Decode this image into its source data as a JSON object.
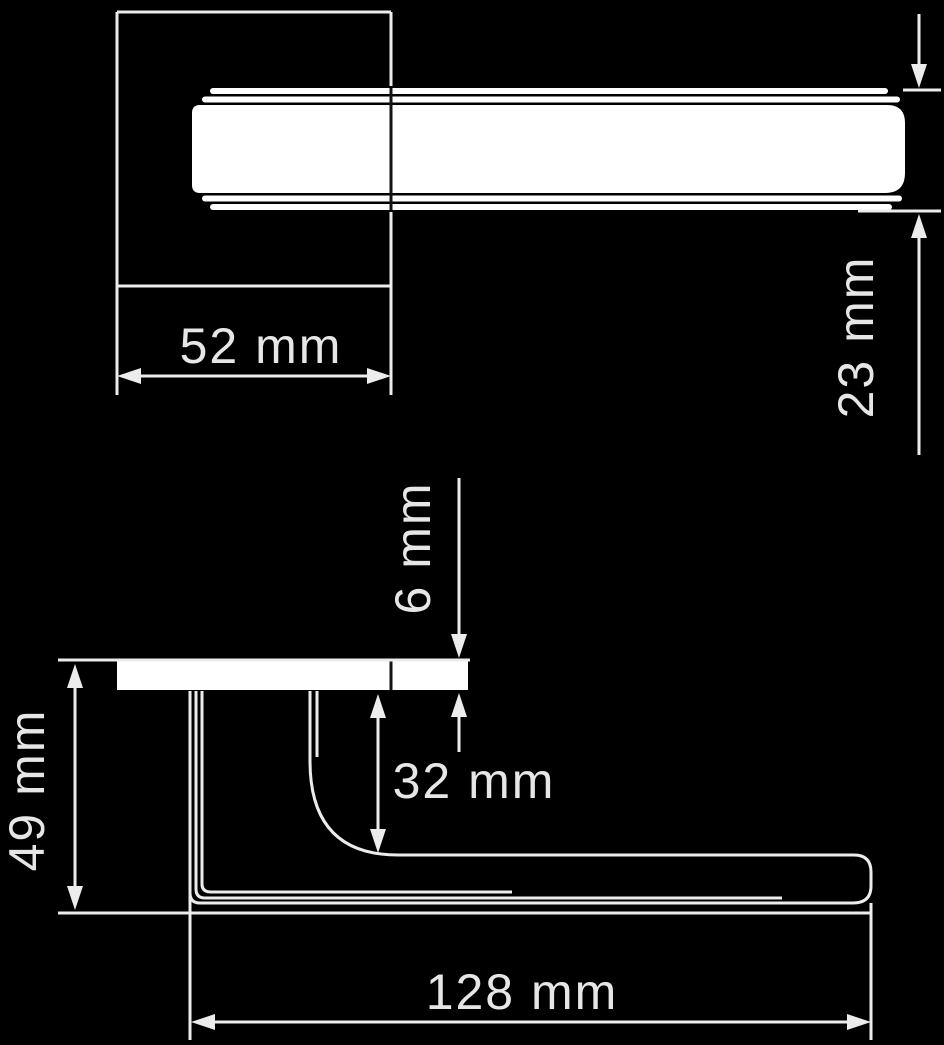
{
  "colors": {
    "background": "#000000",
    "line": "#ececec",
    "text": "#e6e6e6",
    "shape_fill": "#ffffff",
    "detail_line": "#141414"
  },
  "diagram": {
    "dimensions": {
      "rose_width": {
        "label": "52 mm",
        "value": 52,
        "unit": "mm"
      },
      "grip_thickness": {
        "label": "23 mm",
        "value": 23,
        "unit": "mm"
      },
      "rose_depth": {
        "label": "6 mm",
        "value": 6,
        "unit": "mm"
      },
      "neck_clearance": {
        "label": "32 mm",
        "value": 32,
        "unit": "mm"
      },
      "projection": {
        "label": "49 mm",
        "value": 49,
        "unit": "mm"
      },
      "lever_length": {
        "label": "128 mm",
        "value": 128,
        "unit": "mm"
      }
    }
  }
}
